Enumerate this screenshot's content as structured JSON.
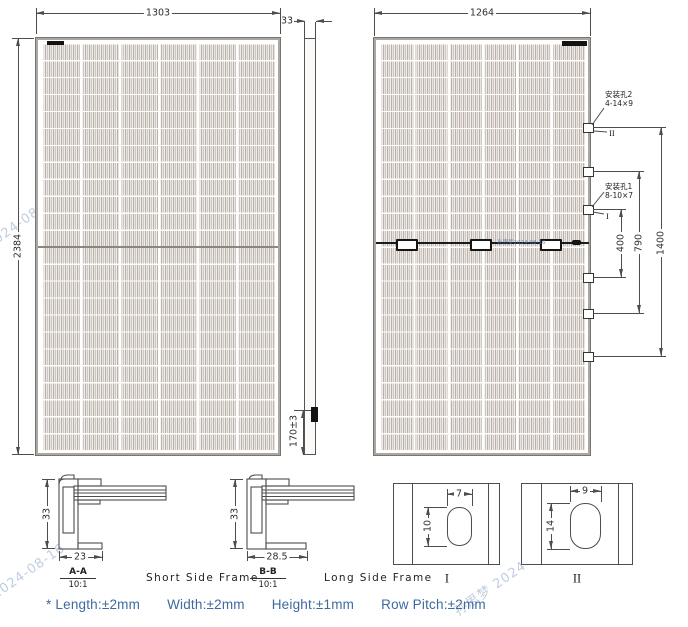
{
  "front_view": {
    "width_mm": "1303",
    "height_mm": "2384"
  },
  "side_view": {
    "thickness_mm": "33",
    "junction_box_offset": "170±3"
  },
  "rear_view": {
    "width_mm": "1264",
    "mounting_hole_2": {
      "name": "安装孔2",
      "spec": "4-14×9",
      "detail_ref": "II"
    },
    "mounting_hole_1": {
      "name": "安装孔1",
      "spec": "8-10×7",
      "detail_ref": "I"
    },
    "spacing_inner": "400",
    "spacing_mid": "790",
    "spacing_outer": "1400"
  },
  "sections": {
    "short": {
      "ref": "A-A",
      "scale": "10:1",
      "title": "Short Side Frame",
      "height_mm": "33",
      "width_mm": "23"
    },
    "long": {
      "ref": "B-B",
      "scale": "10:1",
      "title": "Long Side Frame",
      "height_mm": "33",
      "width_mm": "28.5"
    }
  },
  "details": {
    "i": {
      "ref": "I",
      "slot_width_mm": "7",
      "slot_height_mm": "10"
    },
    "ii": {
      "ref": "II",
      "slot_width_mm": "9",
      "slot_height_mm": "14"
    }
  },
  "tolerances": {
    "items": [
      "* Length:±2mm",
      "Width:±2mm",
      "Height:±1mm",
      "Row Pitch:±2mm"
    ]
  },
  "watermark": {
    "text": "孙思梦 2024-08-16",
    "tiny": "孙思梦2024-08-16"
  },
  "colors": {
    "line": "#4d4d4d",
    "note_text": "#3f6a9e",
    "watermark": "#7d9cc4",
    "cell_fill": "#d8d2cc"
  }
}
